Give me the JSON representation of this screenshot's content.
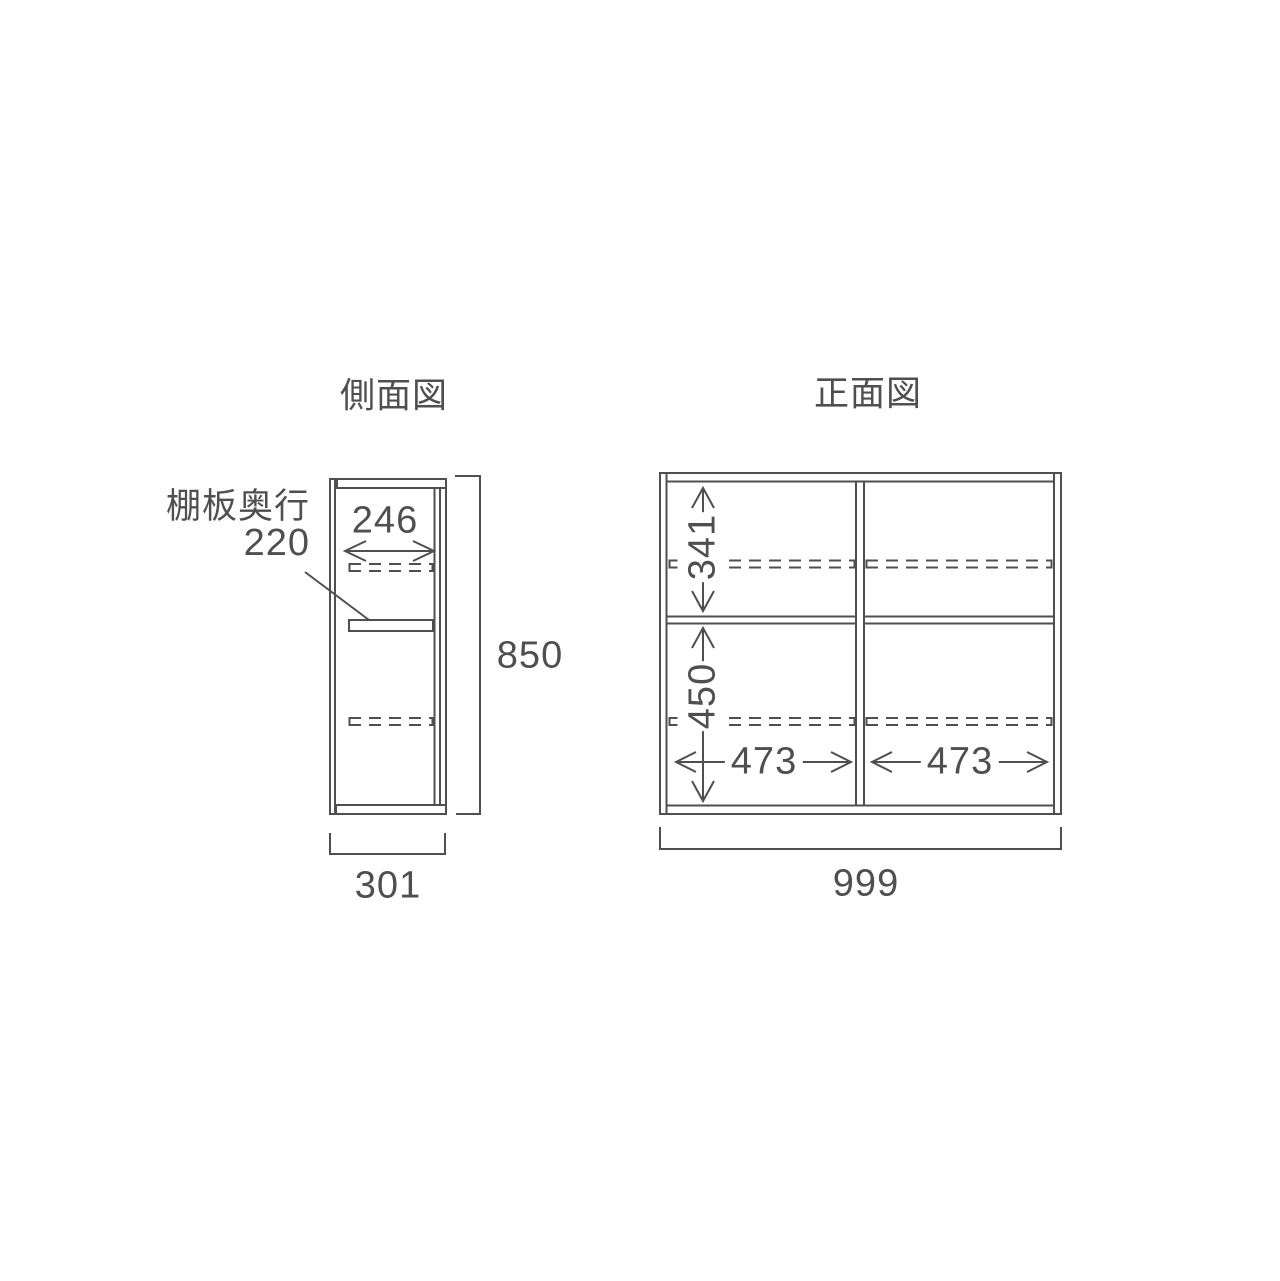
{
  "diagram": {
    "background_color": "#ffffff",
    "line_color": "#4f4f4f",
    "description_units": "mm"
  },
  "side_view": {
    "title": "側面図",
    "shelf_depth_label": "棚板奥行",
    "shelf_depth_value": "220",
    "inner_depth": "246",
    "outer_height": "850",
    "outer_depth": "301"
  },
  "front_view": {
    "title": "正面図",
    "upper_section_height": "341",
    "lower_section_height": "450",
    "left_section_width": "473",
    "right_section_width": "473",
    "outer_width": "999"
  }
}
